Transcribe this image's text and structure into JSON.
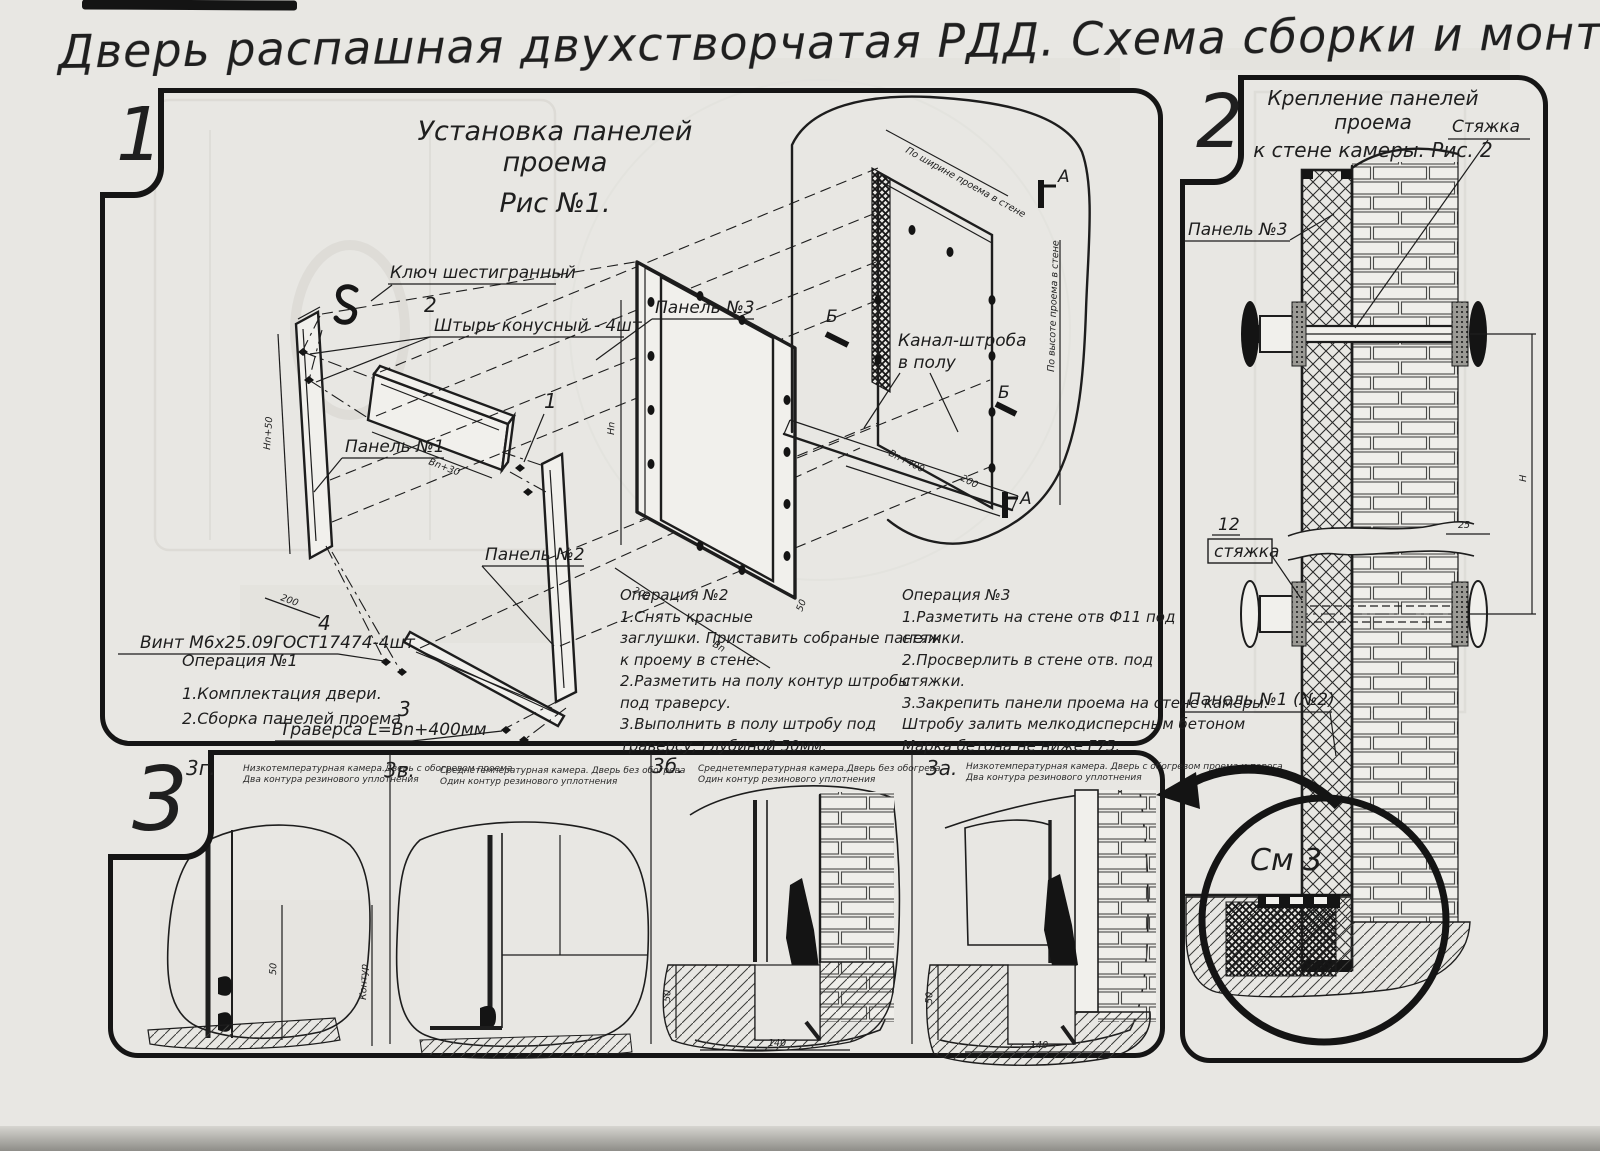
{
  "title": "Дверь распашная двухстворчатая РДД.  Схема сборки и монтажа №2",
  "p1": {
    "badge": "1",
    "h1": "Установка панелей проема",
    "h2": "Рис №1.",
    "c_hexkey": "Ключ шестигранный",
    "c_pin_n": "2",
    "c_pin": "Штырь конусный - 4шт",
    "c_p3": "Панель №3",
    "c_p1": "Панель №1",
    "c_p2": "Панель №2",
    "c_n1": "1",
    "c_scr_n": "4",
    "c_scr": "Винт М6х25.09ГОСТ17474-4шт",
    "c_trav_n": "3",
    "c_trav": "Траверса  L=Bn+400мм",
    "c_ch1": "Канал-штроба",
    "c_ch2": "в полу",
    "mA": "А",
    "mB": "Б",
    "d_hn50": "Hn+50",
    "d_200": "200",
    "d_bn30": "Bn+30",
    "d_hn": "Hn",
    "d_bn": "Bn",
    "d_50": "50",
    "d_bn400": "Bn+400",
    "d_ww": "По ширине проема в стене",
    "d_wh": "По высоте проема в стене",
    "op1": [
      "Операция №1",
      "1.Комплектация двери.",
      "2.Сборка панелей проема"
    ],
    "op2": [
      "Операция №2",
      "1.Снять красные",
      "заглушки. Приставить собраные панели",
      "к проему в стене.",
      "2.Разметить на полу контур штробы",
      "под траверсу.",
      "3.Выполнить в полу штробу под",
      "траверсу, глубиной 50мм."
    ],
    "op3": [
      "Операция №3",
      "1.Разметить на стене отв Ф11 под",
      "стяжки.",
      "2.Просверлить в стене отв.  под",
      "стяжки.",
      "3.Закрепить панели проема на стене камеры.",
      "Штробу залить мелкодисперсным бетоном",
      "Марка бетона не ниже  F75."
    ]
  },
  "p2": {
    "badge": "2",
    "h1": "Крепление панелей проема",
    "h2": "к стене камеры. Рис. 2",
    "c_tie": "Стяжка",
    "c_p3": "Панель №3",
    "c_12": "12",
    "c_tie2": "стяжка",
    "c_p12": "Панель №1 (№2)",
    "c_see": "См 3",
    "d_h": "H",
    "d_25": "25"
  },
  "p3": {
    "badge": "3",
    "cells": [
      {
        "n": "3г.",
        "c1": "Низкотемпературная камера.Дверь с обогревом проема",
        "c2": "Два контура резинового уплотнения",
        "d1": "50",
        "d2": "Контур"
      },
      {
        "n": "3в.",
        "c1": "Среднетемпературная камера. Дверь без обогрева",
        "c2": "Один контур резинового уплотнения"
      },
      {
        "n": "3б.",
        "c1": "Среднетемпературная камера.Дверь без обогрева",
        "c2": "Один контур резинового уплотнения",
        "d1": "50",
        "d2": "140"
      },
      {
        "n": "3а.",
        "c1": "Низкотемпературная камера. Дверь с обогревом проема и порога",
        "c2": "Два контура резинового уплотнения",
        "d1": "50",
        "d2": "140"
      }
    ]
  }
}
